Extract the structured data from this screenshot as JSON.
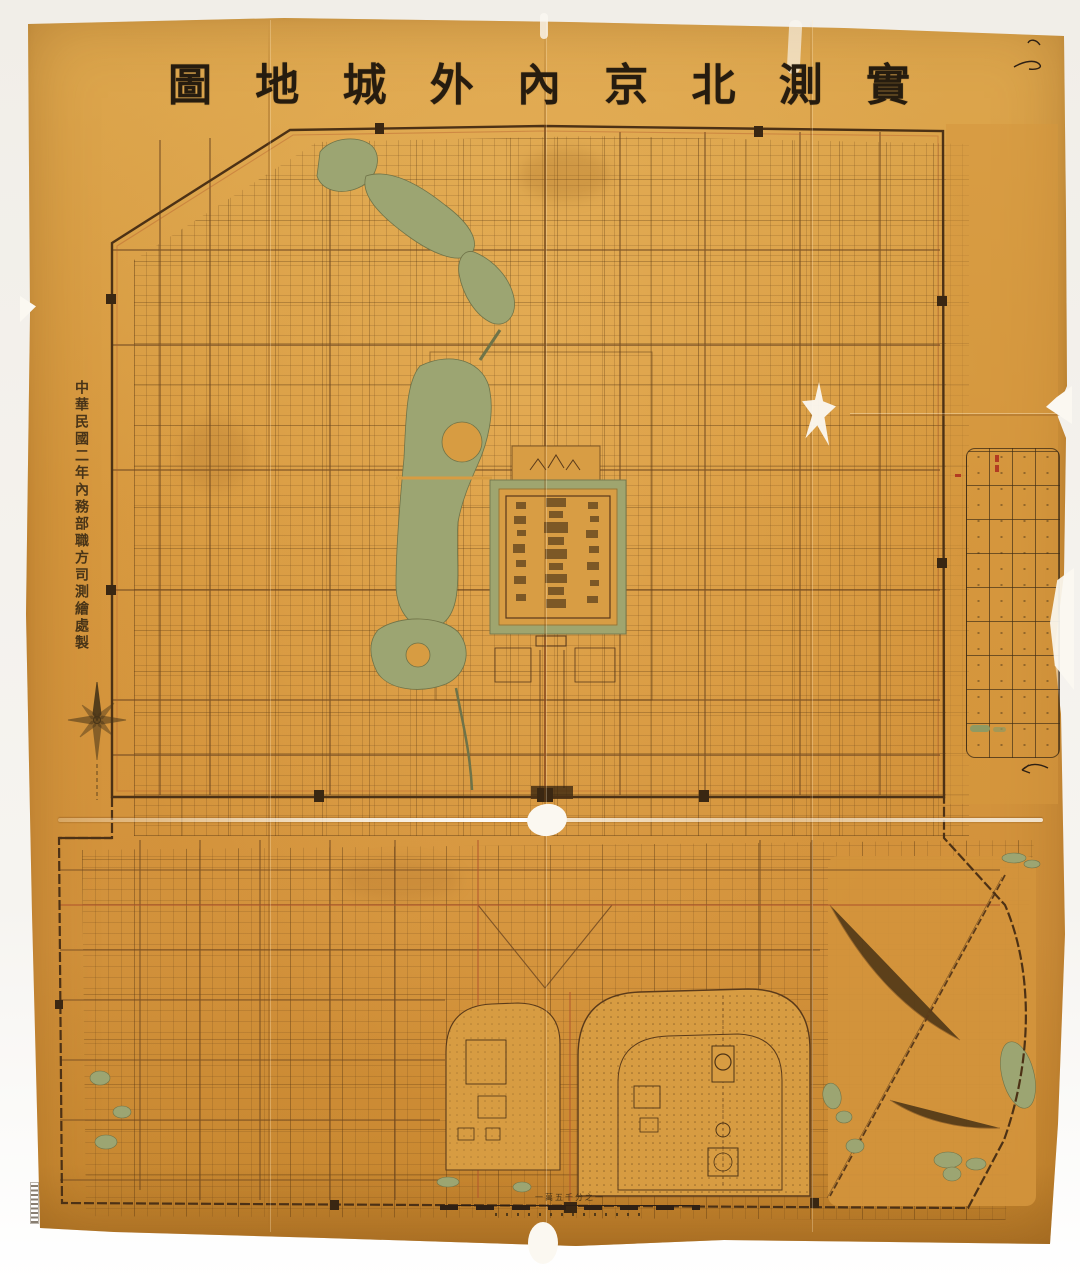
{
  "title": {
    "text": "實測北京內外城地圖",
    "chars": [
      "圖",
      "地",
      "城",
      "外",
      "內",
      "京",
      "北",
      "測",
      "實"
    ]
  },
  "attribution": {
    "text": "中華民國二年內務部職方司測繪處製"
  },
  "scale": {
    "label": "一萬五千分之一"
  },
  "legend": {
    "rows": 9,
    "cols": 4
  },
  "colors": {
    "background": "#f2efe9",
    "paper": "#d6973d",
    "paper_edge": "#c5862f",
    "ink": "#5d3d1c",
    "wall": "#4c3115",
    "red_line": "#b0562c",
    "water": "#9ca572",
    "title_ink": "#261c0f",
    "tear_white": "#fbf8f1"
  }
}
